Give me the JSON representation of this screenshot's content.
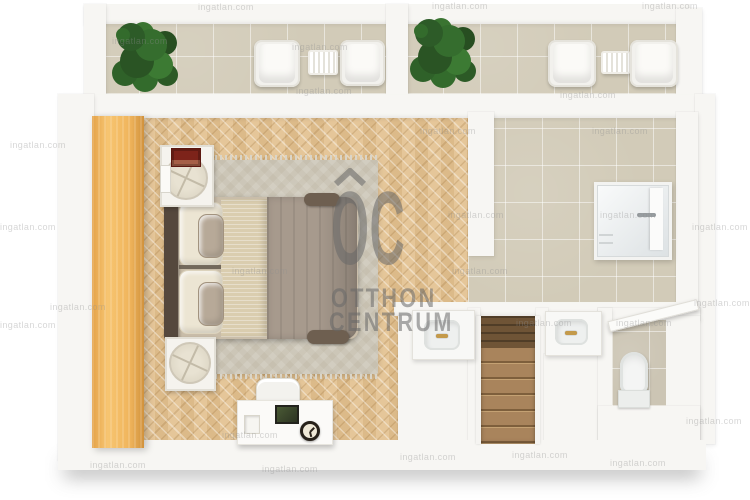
{
  "scene": {
    "kind": "3d-floor-plan-top-view",
    "zones": [
      "balcony-left",
      "balcony-right",
      "bedroom",
      "bathroom",
      "wc",
      "staircase"
    ],
    "furniture": [
      "wardrobe",
      "double-bed",
      "area-rug",
      "nightstand-with-tray",
      "red-book",
      "desk",
      "desk-chair",
      "photo-frame",
      "table-clock",
      "potted-plant",
      "outdoor-armchair",
      "slatted-side-table",
      "shower-cabin",
      "washbasin-vanity",
      "toilet",
      "staircase",
      "interior-door"
    ]
  },
  "logo": {
    "monogram": "OC",
    "name_line1": "OTTHON",
    "name_line2": "CENTRUM"
  },
  "watermark": {
    "text": "ingatlan.com"
  },
  "colors": {
    "background": "#ffffff",
    "wall": "#f7f6f3",
    "parquet": "#e3c291",
    "tile": "#d2cbb8",
    "wardrobe": "#f0b55c",
    "rug": "#ccc6b7",
    "duvet": "#a79a8d",
    "blanket": "#dacdaf",
    "pillow": "#ece5d3",
    "headboard": "#55483d",
    "stairs": "#a9845c",
    "plant": "#336b2c",
    "book": "#7d231a",
    "logo_gray": "#686868"
  }
}
